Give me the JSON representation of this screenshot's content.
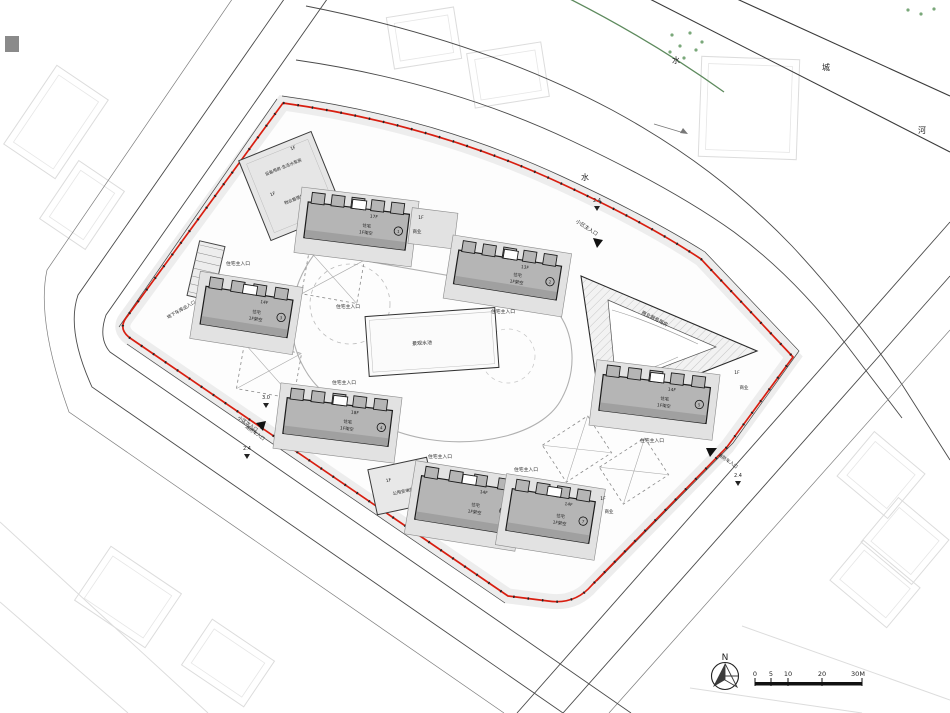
{
  "drawing": {
    "kind": "residential community site plan",
    "north_label": "N"
  },
  "colors": {
    "red_line": "#d81e10",
    "building_fill": "#b5b5b5",
    "podium_fill": "#e2e2e2",
    "road_line": "#4a4a4a",
    "river_green": "#5d8a5d"
  },
  "river": {
    "char1": "水",
    "char2": "城",
    "char3": "河",
    "char4": "水"
  },
  "entrances": {
    "main": "小区主入口",
    "residential": "住宅主入口",
    "garage": "地下车库出入口",
    "pedestrian": "小区次入口",
    "fire": "消防车入口"
  },
  "dimensions": {
    "d24": "2.4",
    "d30": "3.0"
  },
  "facilities": {
    "pool": "景观水池",
    "one_f": "1F",
    "commercial": "商业",
    "retail_block": "商业服务用房",
    "pump": "设备用房·生活水泵房",
    "property": "物业管理用房",
    "substation": "公用变电所"
  },
  "buildings": [
    {
      "floors": "17F",
      "use": "住宅",
      "note": "1F架空",
      "badge": "1"
    },
    {
      "floors": "13F",
      "use": "住宅",
      "note": "1F架空",
      "badge": "2"
    },
    {
      "floors": "14F",
      "use": "住宅",
      "note": "1F架空",
      "badge": "3"
    },
    {
      "floors": "18F",
      "use": "住宅",
      "note": "1F架空",
      "badge": "4"
    },
    {
      "floors": "14F",
      "use": "住宅",
      "note": "1F架空",
      "badge": "5"
    },
    {
      "floors": "14F",
      "use": "住宅",
      "note": "1F架空",
      "badge": "6"
    },
    {
      "floors": "14F",
      "use": "住宅",
      "note": "1F架空",
      "badge": "7"
    }
  ],
  "scale_bar": {
    "t0": "0",
    "t1": "5",
    "t2": "10",
    "t3": "20",
    "t4": "30M"
  }
}
